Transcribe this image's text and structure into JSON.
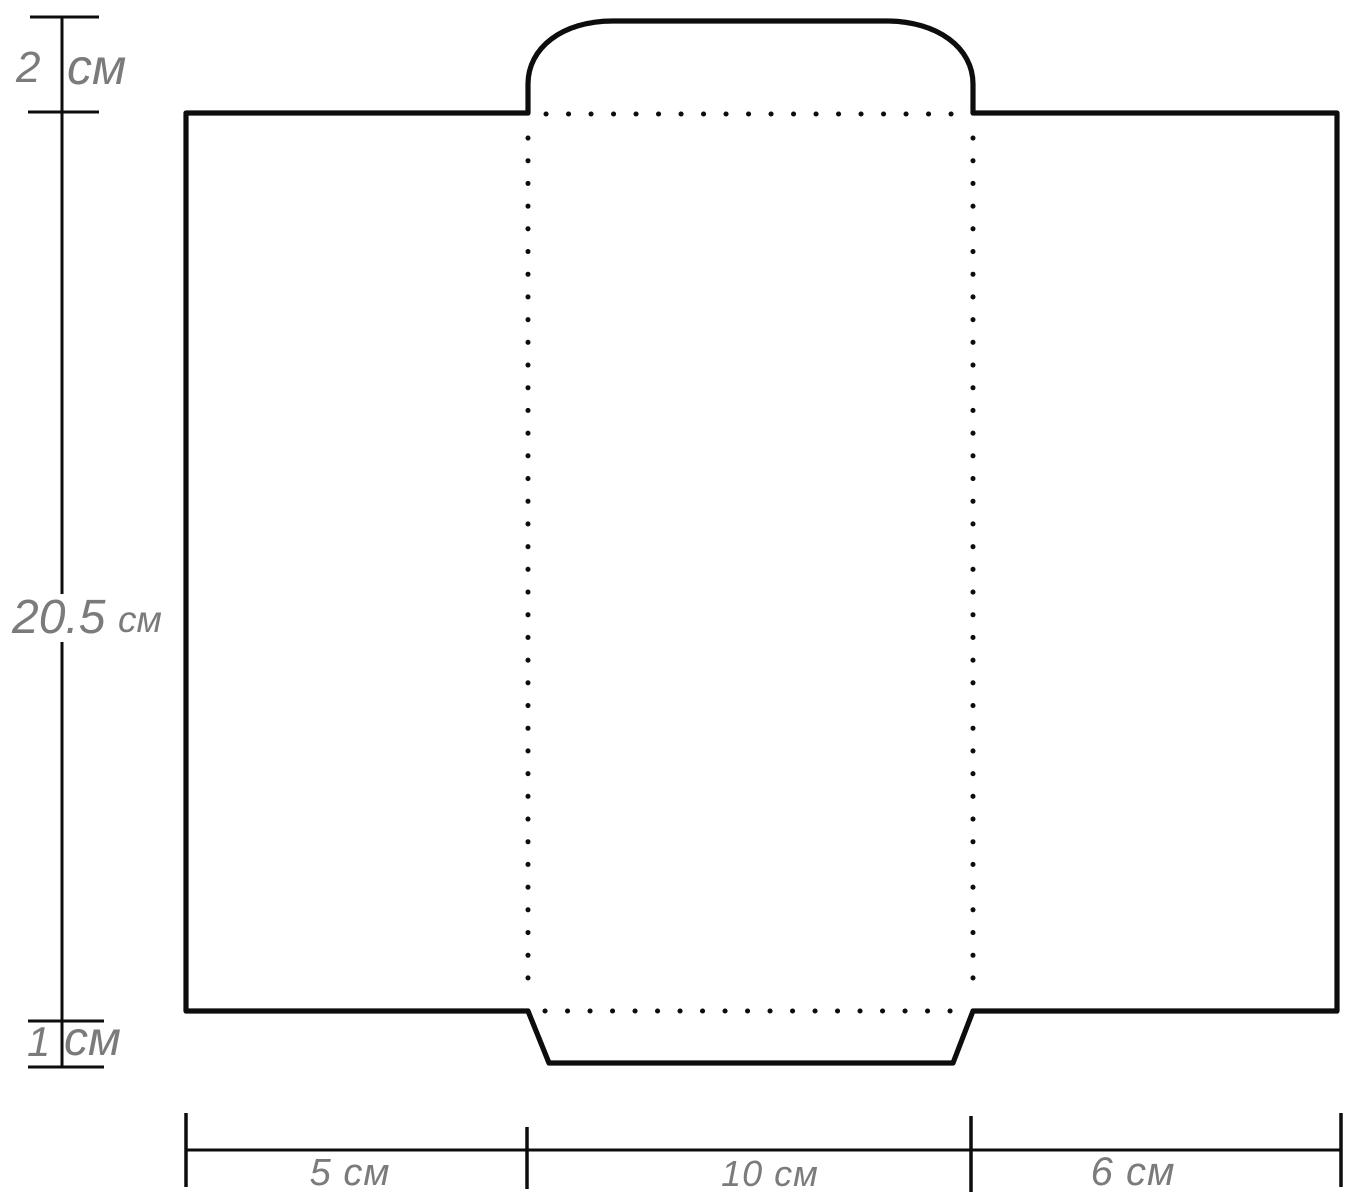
{
  "figure": {
    "type": "envelope-template-diagram",
    "colors": {
      "line": "#0d0d0d",
      "label": "#7b7b7b",
      "background": "#ffffff"
    },
    "dimensions": {
      "top_flap_height": {
        "value": "2",
        "unit": "см"
      },
      "body_height": {
        "value": "20.5",
        "unit": "см"
      },
      "bottom_flap_height": {
        "value": "1",
        "unit": "см"
      },
      "bottom_panels": [
        {
          "label": "5 см"
        },
        {
          "label": "10 см"
        },
        {
          "label": "6 см"
        }
      ]
    }
  }
}
